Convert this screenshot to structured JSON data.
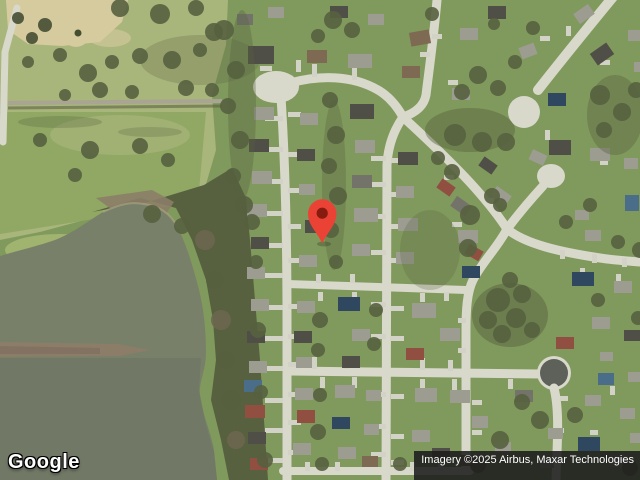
{
  "branding": {
    "logo_text": "Google"
  },
  "attribution": {
    "text": "Imagery ©2025 Airbus, Maxar Technologies"
  },
  "marker": {
    "label": "location-pin",
    "color": "#EA4335",
    "inner_color": "#871B10"
  },
  "map": {
    "view_type": "satellite"
  },
  "palette": {
    "grass": "#80995c",
    "park": "#a8b57b",
    "field": "#90a863",
    "tree": "#57613f",
    "tree_dark": "#454e33",
    "water": "#798069",
    "water_deep": "#6f7565",
    "sand": "#d6cb9e",
    "beach": "#8b7d67",
    "road": "#d8d8cb",
    "asphalt_court": "#5e6159",
    "attribution_bg": "rgba(28,28,28,0.88)",
    "attribution_text": "#ffffff",
    "logo_text_color": "#ffffff",
    "logo_outline": "#000000"
  }
}
